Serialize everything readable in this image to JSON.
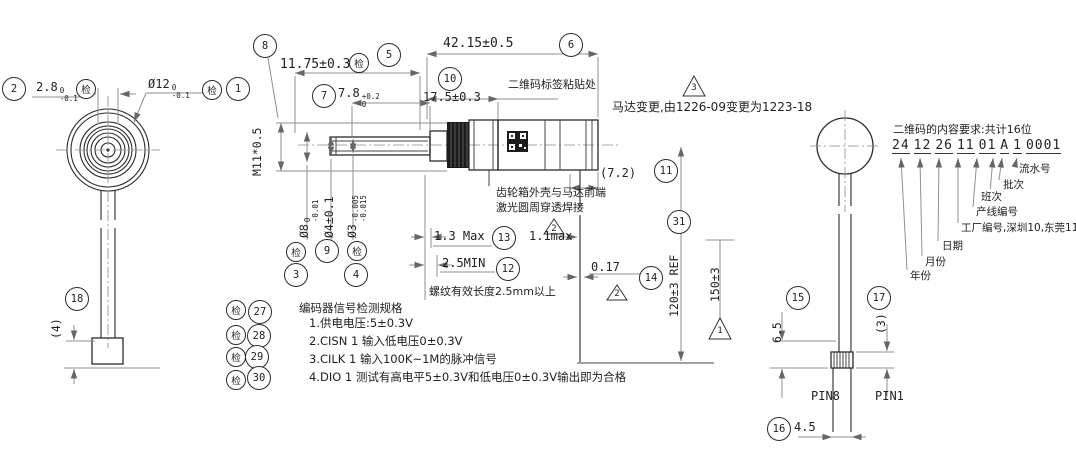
{
  "balloons": {
    "b1": "1",
    "b2": "2",
    "b3": "3",
    "b4": "4",
    "b5": "5",
    "b6": "6",
    "b7": "7",
    "b8": "8",
    "b9": "9",
    "b10": "10",
    "b11": "11",
    "b12": "12",
    "b13": "13",
    "b14": "14",
    "b15": "15",
    "b16": "16",
    "b17": "17",
    "b18": "18",
    "b27": "27",
    "b28": "28",
    "b29": "29",
    "b30": "30",
    "b31": "31",
    "inspect": "检"
  },
  "flags": {
    "t1": "1",
    "t2": "2",
    "t3": "3"
  },
  "dims": {
    "d2_8": {
      "val": "2.8",
      "tol_top": "0",
      "tol_bot": "-0.1"
    },
    "d12": {
      "val": "Ø12",
      "tol_top": "0",
      "tol_bot": "-0.1"
    },
    "d11_75": "11.75±0.3",
    "d7_8": {
      "val": "7.8",
      "tol_top": "+0.2",
      "tol_bot": "0"
    },
    "d42_15": "42.15±0.5",
    "d17_5": "17.5±0.3",
    "m11": "M11*0.5",
    "d8": {
      "val": "Ø8",
      "tol_top": "0",
      "tol_bot": "-0.01"
    },
    "d4": "Ø4±0.1",
    "d3": {
      "val": "Ø3",
      "tol_top": "-0.005",
      "tol_bot": "-0.015"
    },
    "d7_2": "(7.2)",
    "d1_3": "1.3 Max",
    "d1_1": "1.1max",
    "d2_5": "2.5MIN",
    "d0_17": "0.17",
    "d120": "120±3  REF",
    "d150": "150±3",
    "d4ref": "(4)",
    "d6_5": "6.5",
    "d3ref": "(3)",
    "d4_5": "4.5",
    "pin8": "PIN8",
    "pin1": "PIN1"
  },
  "notes": {
    "qr_label": "二维码标签粘贴处",
    "motor_change": "马达变更,由1226-09变更为1223-18",
    "weld1": "齿轮箱外壳与马达前端",
    "weld2": "激光圆周穿透焊接",
    "thread": "螺纹有效长度2.5mm以上"
  },
  "qr_spec": {
    "title": "二维码的内容要求:共计16位",
    "groups": [
      "24",
      "12",
      "26",
      "11",
      "01",
      "A",
      "1",
      "0001"
    ],
    "labels": [
      "流水号",
      "批次",
      "班次",
      "产线编号",
      "工厂编号,深圳10,东莞11",
      "日期",
      "月份",
      "年份"
    ]
  },
  "encoder_spec": {
    "title": "编码器信号检测规格",
    "lines": [
      "1.供电电压:5±0.3V",
      "2.CISN 1 输入低电压0±0.3V",
      "3.CILK 1 输入100K~1M的脉冲信号",
      "4.DIO 1 测试有高电平5±0.3V和低电压0±0.3V输出即为合格"
    ]
  }
}
